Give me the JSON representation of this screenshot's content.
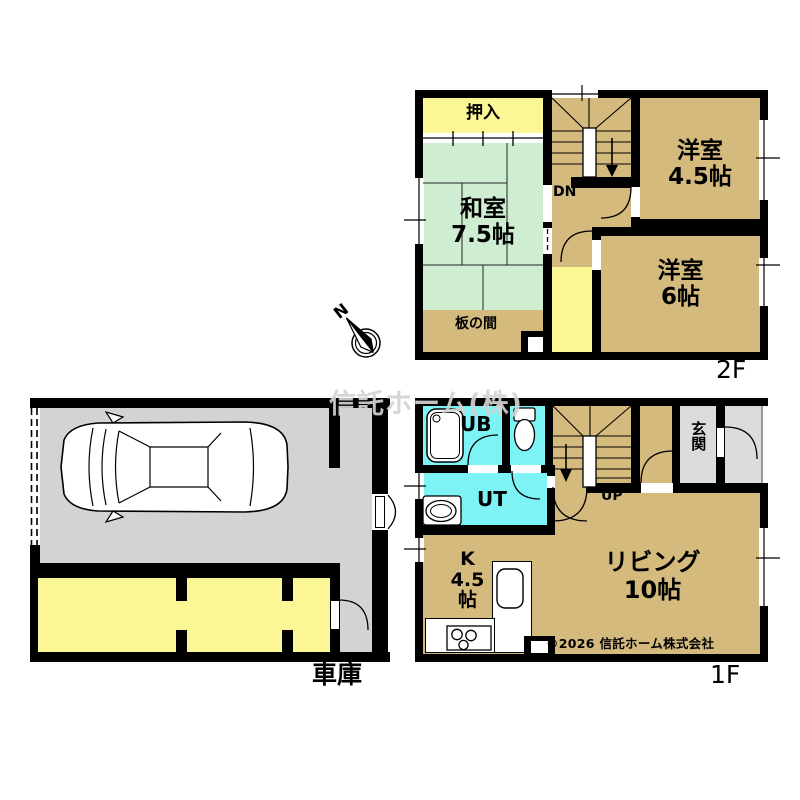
{
  "watermark": "信託ホーム(株)",
  "compass": {
    "north": "N"
  },
  "floor2": {
    "label": "2F",
    "oshiire": "押入",
    "washitsu": {
      "name": "和室",
      "size": "7.5帖"
    },
    "youshitsu45": {
      "name": "洋室",
      "size": "4.5帖"
    },
    "youshitsu6": {
      "name": "洋室",
      "size": "6帖"
    },
    "itanoma": "板の間",
    "stairs_dn": "DN"
  },
  "floor1": {
    "label": "1F",
    "ub": "UB",
    "ut": "UT",
    "stairs_up": "UP",
    "genkan": "玄関",
    "living": {
      "name": "リビング",
      "size": "10帖"
    },
    "kitchen": {
      "name": "K",
      "size_num": "4.5",
      "size_unit": "帖"
    },
    "copyright": "©2026 信託ホーム株式会社"
  },
  "garage": {
    "label": "車庫"
  },
  "colors": {
    "wall": "#000000",
    "room_tan": "#d5ba7e",
    "tatami_green": "#cfeed1",
    "closet_yellow": "#fbf795",
    "wet_area_cyan": "#7df3f6",
    "garage_gray": "#d3d3d3",
    "entry_gray": "#dcdcdc",
    "watermark_gray": "#d6d6d6"
  }
}
